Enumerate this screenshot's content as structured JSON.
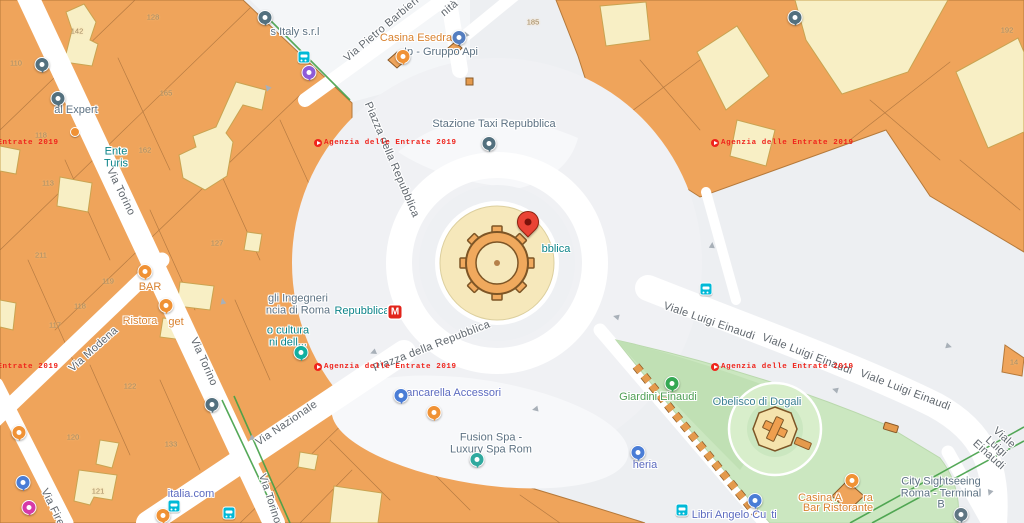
{
  "streets": {
    "via_torino": "Via Torino",
    "via_modena": "Via Modena",
    "via_nazionale": "Via Nazionale",
    "via_firenze": "Via Firenze",
    "via_pietro_barbieri": "Via Pietro Barbieri",
    "top_fragment": "nità",
    "piazza_della_repubblica": "Piazza della Repubblica",
    "viale_luigi_einaudi": "Viale Luigi Einaudi"
  },
  "pois": {
    "expert": "al Expert",
    "italy_srl": "s Italy s.r.l",
    "ente_turismo": "Ente\nTuris",
    "casina_esedra": "Casina Esedra",
    "ip_gruppo_api": "Ip - Gruppo Api",
    "stazione_taxi": "Stazione Taxi Repubblica",
    "metro_name": "Repubblica",
    "metro_m": "M",
    "repubblica_fragment": "bblica",
    "ingegneri": "gli Ingegneri\nncia di Roma",
    "cultura": "o cultura\nni dell...",
    "bar": "BAR",
    "ristorante_a": "Ristora",
    "ristorante_b": "get",
    "bancarella": "Bancarella Accessori",
    "fusion_spa": "Fusion Spa -\nLuxury Spa Rom",
    "italia_com": "italia.com",
    "giardini_einaudi": "Giardini Einaudi",
    "obelisco": "Obelisco di Dogali",
    "heria": "heria",
    "libri_a": "Libri Angelo Cu",
    "libri_b": "ti",
    "casina_bar_1a": "Casina A",
    "casina_bar_1b": "ra",
    "casina_bar_2": "Bar Ristorante",
    "city_sightseeing": "City Sightseeing\nRoma - Terminal B"
  },
  "watermark": {
    "text": "Agenzia delle Entrate 2019"
  },
  "house_numbers": [
    "128",
    "142",
    "110",
    "165",
    "118",
    "162",
    "113",
    "211",
    "119",
    "118",
    "117",
    "127",
    "122",
    "120",
    "133",
    "121",
    "185",
    "192",
    "14"
  ],
  "colors": {
    "building_orange": "#efa45b",
    "building_cream": "#f8efc5",
    "park_green": "#cbe7c0",
    "street_white": "#ffffff",
    "pin_red": "#ea4335",
    "metro_red": "#e2231a",
    "watermark_red": "#ef241c",
    "poi_blue": "#5d7283",
    "poi_indigo": "#5c6bc0",
    "poi_teal": "#0c8489",
    "poi_green": "#4e9e54",
    "poi_orange": "#d9822f",
    "route_green": "#43a047"
  }
}
